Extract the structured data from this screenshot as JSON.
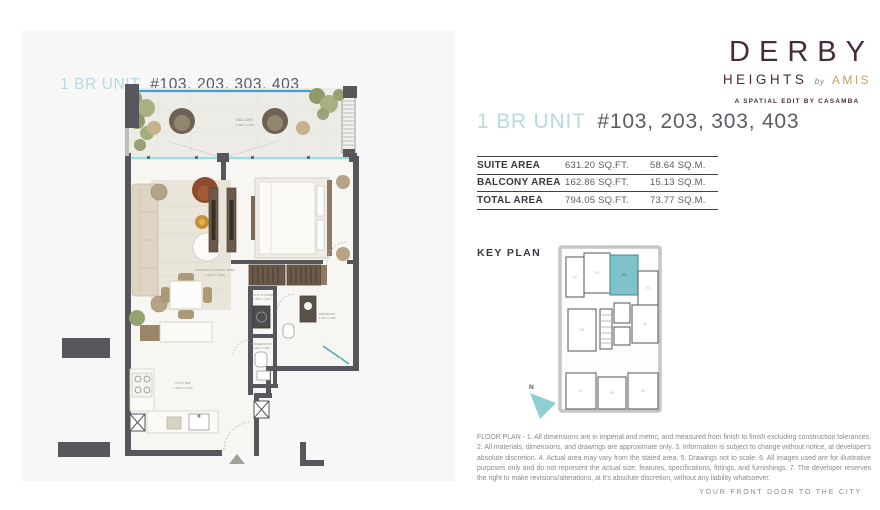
{
  "plan_card": {
    "title_prefix": "1 BR UNIT",
    "title_units": "#103, 203, 303, 403"
  },
  "brand": {
    "name": "DERBY",
    "sub_name": "HEIGHTS",
    "by_word": "by",
    "by_brand": "AMIS",
    "tagline": "A SPATIAL EDIT BY CASAMBA"
  },
  "details": {
    "title_prefix": "1 BR UNIT",
    "title_units": "#103, 203, 303, 403",
    "area_rows": [
      {
        "label": "SUITE AREA",
        "sqft": "631.20 SQ.FT.",
        "sqm": "58.64 SQ.M."
      },
      {
        "label": "BALCONY AREA",
        "sqft": "162.86 SQ.FT.",
        "sqm": "15.13 SQ.M."
      },
      {
        "label": "TOTAL AREA",
        "sqft": "794.05 SQ.FT.",
        "sqm": "73.77 SQ.M."
      }
    ],
    "key_plan_label": "KEY PLAN",
    "north_label": "N",
    "disclaimer": "FLOOR PLAN - 1. All dimensions are in imperial and metric, and measured from finish to finish excluding construction tolerances. 2. All materials, dimensions, and drawings are approximate only. 3. Information is subject to change without notice, at developer's absolute discretion. 4. Actual area may vary from the stated area. 5. Drawings not to scale. 6. All images used are for illustrative purposes only and do not represent the actual size, features, specifications, fittings, and furnishings. 7. The developer reserves the right to make revisions/alterations, at it's absolute discretion, without any liability whatsoever."
  },
  "key_plan_units": [
    {
      "label": "01",
      "highlighted": false
    },
    {
      "label": "02",
      "highlighted": false
    },
    {
      "label": "03",
      "highlighted": true
    },
    {
      "label": "04",
      "highlighted": false
    },
    {
      "label": "05",
      "highlighted": false
    },
    {
      "label": "06",
      "highlighted": false
    },
    {
      "label": "07",
      "highlighted": false
    },
    {
      "label": "08",
      "highlighted": false
    },
    {
      "label": "09",
      "highlighted": false
    }
  ],
  "floor_plan_rooms": {
    "balcony": {
      "name": "BALCONY",
      "dims": "8.08M X 1.85M"
    },
    "lounge": {
      "name": "LOUNGE & DINING AREA",
      "dims": "5.48M X 3.55M"
    },
    "bedroom": {
      "name": "BEDROOM",
      "dims": "3.48M X 3.10M"
    },
    "kitchen": {
      "name": "KITCHEN",
      "dims": "3.28M X 2.31M"
    },
    "utility": {
      "name": "UTILITY & STORE",
      "dims": "1.48M X 1.31M"
    },
    "powder": {
      "name": "POWDER ROOM",
      "dims": "1.28M X 1.45M"
    },
    "bathroom": {
      "name": "BATHROOM",
      "dims": "1.75M X 2.45M"
    }
  },
  "footer": {
    "tagline": "YOUR FRONT DOOR TO THE CITY"
  },
  "colors": {
    "accent_teal": "#7ec3cb",
    "title_blue": "#b7d9e0",
    "ink": "#43404a",
    "brand_plum": "#472a3c",
    "brand_gold": "#c3a36a",
    "wall_gray": "#56565c",
    "glass_blue": "#3f9fd8",
    "muted_gray": "#8a8790"
  }
}
